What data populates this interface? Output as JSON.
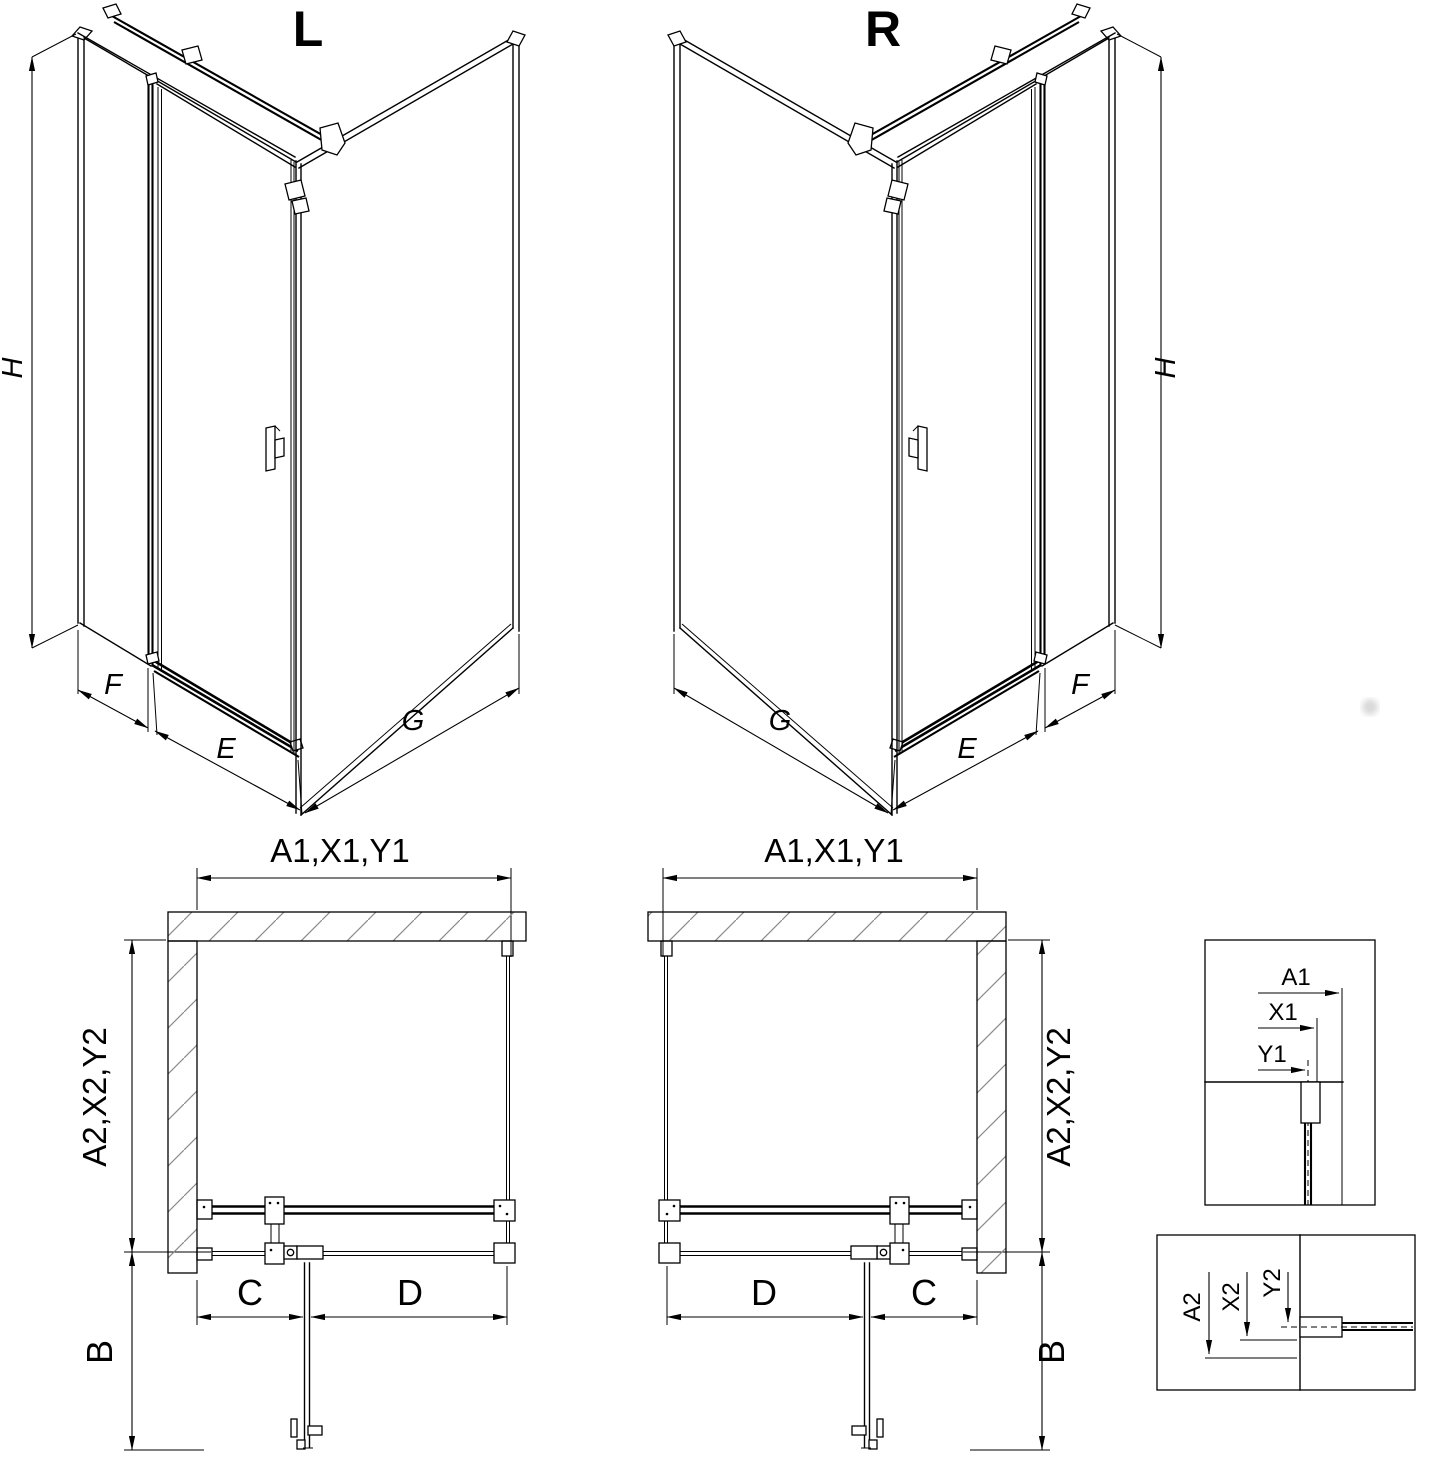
{
  "drawing": {
    "type": "shower-enclosure-technical-drawing",
    "variants": [
      "L",
      "R"
    ]
  },
  "iso_left": {
    "title": "L",
    "dim_height": "H",
    "dim_side_panel": "F",
    "dim_door": "E",
    "dim_return_wall": "G"
  },
  "iso_right": {
    "title": "R",
    "dim_height": "H",
    "dim_side_panel": "F",
    "dim_door": "E",
    "dim_return_wall": "G"
  },
  "plan_left": {
    "dim_top": "A1,X1,Y1",
    "dim_side": "A2,X2,Y2",
    "dim_door_open": "B",
    "dim_fixed_part": "C",
    "dim_door_part": "D"
  },
  "plan_right": {
    "dim_top": "A1,X1,Y1",
    "dim_side": "A2,X2,Y2",
    "dim_door_open": "B",
    "dim_fixed_part": "C",
    "dim_door_part": "D"
  },
  "detail_top": {
    "dim_a": "A1",
    "dim_x": "X1",
    "dim_y": "Y1"
  },
  "detail_bottom": {
    "dim_a": "A2",
    "dim_x": "X2",
    "dim_y": "Y2"
  },
  "colors": {
    "line": "#000000",
    "hatch": "#8a8a8a",
    "background": "#ffffff",
    "faint_dot": "#d9d9d9"
  }
}
